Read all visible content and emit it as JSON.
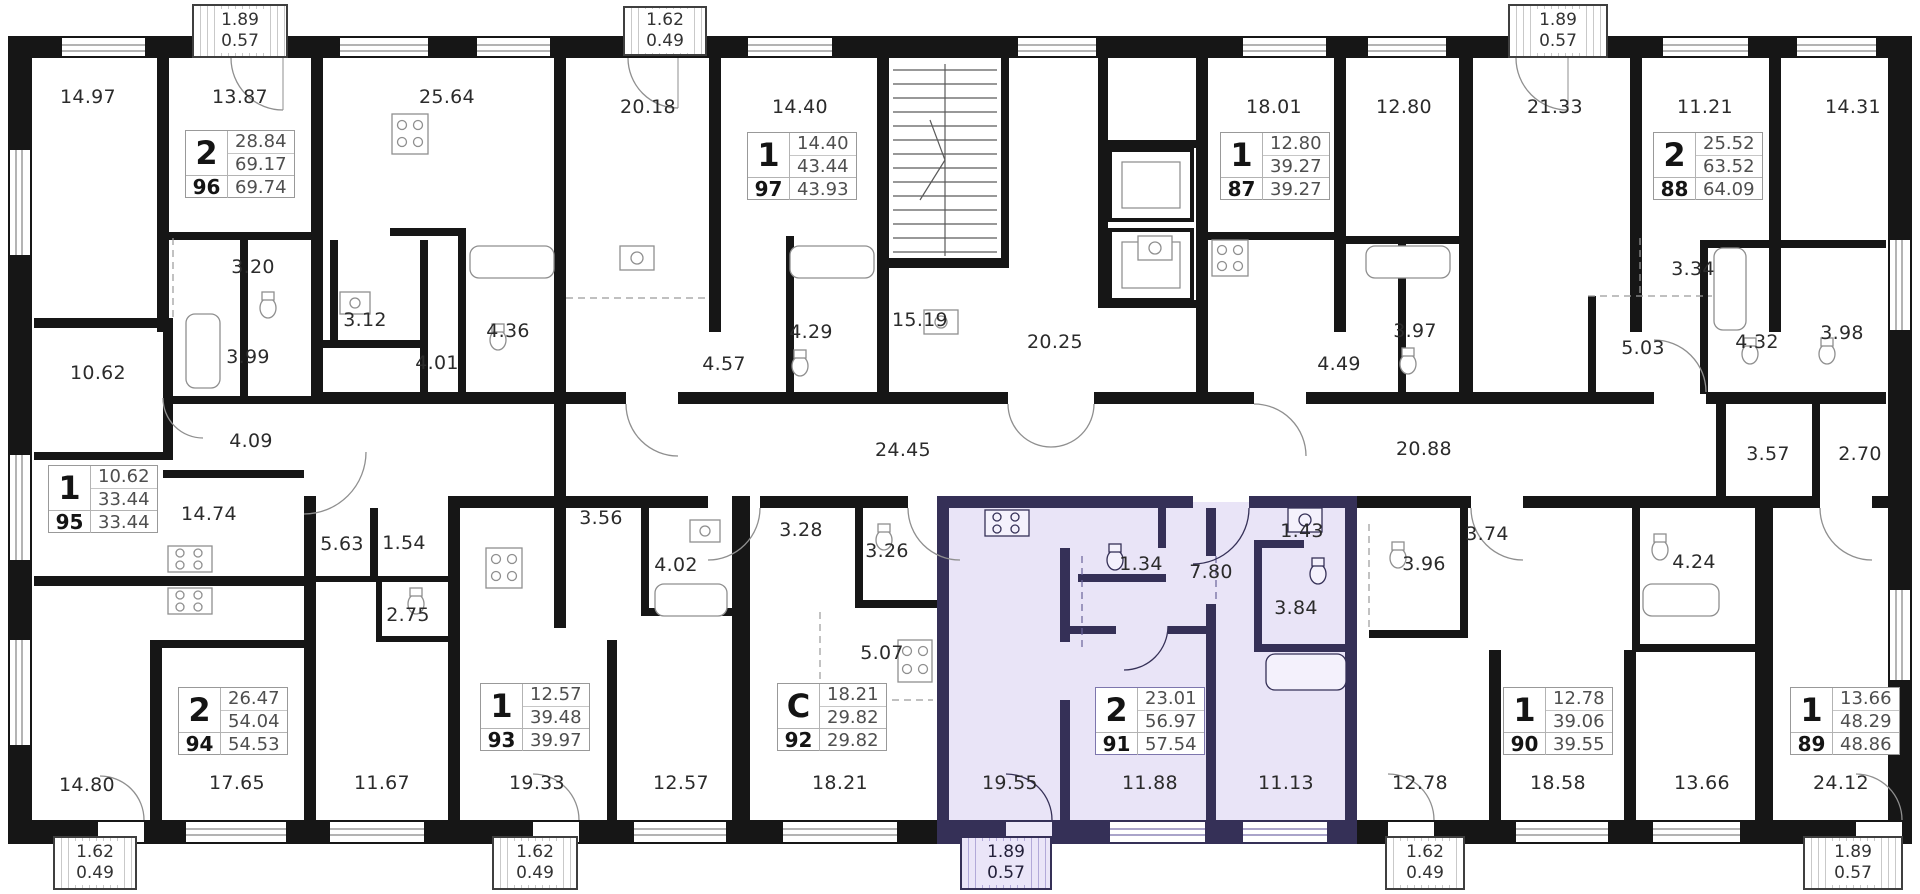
{
  "plan": {
    "colors": {
      "wall": "#161616",
      "highlight_fill": "#e9e4f7",
      "highlight_wall": "#353057",
      "label_text": "#2b2b2b",
      "value_text": "#4f4f4f"
    },
    "room_labels": [
      {
        "t": "14.97",
        "x": 88,
        "y": 97
      },
      {
        "t": "13.87",
        "x": 240,
        "y": 97
      },
      {
        "t": "25.64",
        "x": 447,
        "y": 97
      },
      {
        "t": "20.18",
        "x": 648,
        "y": 107
      },
      {
        "t": "14.40",
        "x": 800,
        "y": 107
      },
      {
        "t": "18.01",
        "x": 1274,
        "y": 107
      },
      {
        "t": "12.80",
        "x": 1404,
        "y": 107
      },
      {
        "t": "21.33",
        "x": 1555,
        "y": 107
      },
      {
        "t": "11.21",
        "x": 1705,
        "y": 107
      },
      {
        "t": "14.31",
        "x": 1853,
        "y": 107
      },
      {
        "t": "3.20",
        "x": 253,
        "y": 267
      },
      {
        "t": "3.12",
        "x": 365,
        "y": 320
      },
      {
        "t": "3.99",
        "x": 248,
        "y": 357
      },
      {
        "t": "10.62",
        "x": 98,
        "y": 373
      },
      {
        "t": "4.01",
        "x": 437,
        "y": 363
      },
      {
        "t": "4.36",
        "x": 508,
        "y": 331
      },
      {
        "t": "4.57",
        "x": 724,
        "y": 364
      },
      {
        "t": "4.29",
        "x": 811,
        "y": 332
      },
      {
        "t": "15.19",
        "x": 920,
        "y": 320
      },
      {
        "t": "20.25",
        "x": 1055,
        "y": 342
      },
      {
        "t": "4.49",
        "x": 1339,
        "y": 364
      },
      {
        "t": "3.97",
        "x": 1415,
        "y": 331
      },
      {
        "t": "3.34",
        "x": 1693,
        "y": 269
      },
      {
        "t": "5.03",
        "x": 1643,
        "y": 348
      },
      {
        "t": "4.32",
        "x": 1757,
        "y": 342
      },
      {
        "t": "3.98",
        "x": 1842,
        "y": 333
      },
      {
        "t": "4.09",
        "x": 251,
        "y": 441
      },
      {
        "t": "24.45",
        "x": 903,
        "y": 450
      },
      {
        "t": "20.88",
        "x": 1424,
        "y": 449
      },
      {
        "t": "3.57",
        "x": 1768,
        "y": 454
      },
      {
        "t": "2.70",
        "x": 1860,
        "y": 454
      },
      {
        "t": "14.74",
        "x": 209,
        "y": 514
      },
      {
        "t": "5.63",
        "x": 342,
        "y": 544
      },
      {
        "t": "1.54",
        "x": 404,
        "y": 543
      },
      {
        "t": "2.75",
        "x": 408,
        "y": 615
      },
      {
        "t": "3.56",
        "x": 601,
        "y": 518
      },
      {
        "t": "4.02",
        "x": 676,
        "y": 565
      },
      {
        "t": "3.28",
        "x": 801,
        "y": 530
      },
      {
        "t": "3.26",
        "x": 887,
        "y": 551
      },
      {
        "t": "5.07",
        "x": 882,
        "y": 653
      },
      {
        "t": "1.34",
        "x": 1141,
        "y": 564
      },
      {
        "t": "7.80",
        "x": 1211,
        "y": 572
      },
      {
        "t": "1.43",
        "x": 1302,
        "y": 531
      },
      {
        "t": "3.84",
        "x": 1296,
        "y": 608
      },
      {
        "t": "3.96",
        "x": 1424,
        "y": 564
      },
      {
        "t": "3.74",
        "x": 1487,
        "y": 534
      },
      {
        "t": "4.24",
        "x": 1694,
        "y": 562
      },
      {
        "t": "14.80",
        "x": 87,
        "y": 785
      },
      {
        "t": "17.65",
        "x": 237,
        "y": 783
      },
      {
        "t": "11.67",
        "x": 382,
        "y": 783
      },
      {
        "t": "19.33",
        "x": 537,
        "y": 783
      },
      {
        "t": "12.57",
        "x": 681,
        "y": 783
      },
      {
        "t": "18.21",
        "x": 840,
        "y": 783
      },
      {
        "t": "19.55",
        "x": 1010,
        "y": 783
      },
      {
        "t": "11.88",
        "x": 1150,
        "y": 783
      },
      {
        "t": "11.13",
        "x": 1286,
        "y": 783
      },
      {
        "t": "12.78",
        "x": 1420,
        "y": 783
      },
      {
        "t": "18.58",
        "x": 1558,
        "y": 783
      },
      {
        "t": "13.66",
        "x": 1702,
        "y": 783
      },
      {
        "t": "24.12",
        "x": 1841,
        "y": 783
      }
    ],
    "apartments": [
      {
        "number": "96",
        "rooms": "2",
        "area_top": "28.84",
        "area_mid": "69.17",
        "area_total": "69.74",
        "x": 185,
        "y": 130,
        "highlighted": false
      },
      {
        "number": "97",
        "rooms": "1",
        "area_top": "14.40",
        "area_mid": "43.44",
        "area_total": "43.93",
        "x": 747,
        "y": 132,
        "highlighted": false
      },
      {
        "number": "87",
        "rooms": "1",
        "area_top": "12.80",
        "area_mid": "39.27",
        "area_total": "39.27",
        "x": 1220,
        "y": 132,
        "highlighted": false
      },
      {
        "number": "88",
        "rooms": "2",
        "area_top": "25.52",
        "area_mid": "63.52",
        "area_total": "64.09",
        "x": 1653,
        "y": 132,
        "highlighted": false
      },
      {
        "number": "95",
        "rooms": "1",
        "area_top": "10.62",
        "area_mid": "33.44",
        "area_total": "33.44",
        "x": 48,
        "y": 465,
        "highlighted": false
      },
      {
        "number": "94",
        "rooms": "2",
        "area_top": "26.47",
        "area_mid": "54.04",
        "area_total": "54.53",
        "x": 178,
        "y": 687,
        "highlighted": false
      },
      {
        "number": "93",
        "rooms": "1",
        "area_top": "12.57",
        "area_mid": "39.48",
        "area_total": "39.97",
        "x": 480,
        "y": 683,
        "highlighted": false
      },
      {
        "number": "92",
        "rooms": "C",
        "area_top": "18.21",
        "area_mid": "29.82",
        "area_total": "29.82",
        "x": 777,
        "y": 683,
        "highlighted": false
      },
      {
        "number": "91",
        "rooms": "2",
        "area_top": "23.01",
        "area_mid": "56.97",
        "area_total": "57.54",
        "x": 1095,
        "y": 687,
        "highlighted": true
      },
      {
        "number": "90",
        "rooms": "1",
        "area_top": "12.78",
        "area_mid": "39.06",
        "area_total": "39.55",
        "x": 1503,
        "y": 687,
        "highlighted": false
      },
      {
        "number": "89",
        "rooms": "1",
        "area_top": "13.66",
        "area_mid": "48.29",
        "area_total": "48.86",
        "x": 1790,
        "y": 687,
        "highlighted": false
      }
    ],
    "balconies": [
      {
        "width_m": "1.89",
        "depth_m": "0.57",
        "x": 192,
        "y": 4,
        "w": 96,
        "h": 54,
        "highlighted": false
      },
      {
        "width_m": "1.62",
        "depth_m": "0.49",
        "x": 623,
        "y": 6,
        "w": 84,
        "h": 50,
        "highlighted": false
      },
      {
        "width_m": "1.89",
        "depth_m": "0.57",
        "x": 1508,
        "y": 4,
        "w": 100,
        "h": 54,
        "highlighted": false
      },
      {
        "width_m": "1.62",
        "depth_m": "0.49",
        "x": 53,
        "y": 836,
        "w": 84,
        "h": 54,
        "highlighted": false
      },
      {
        "width_m": "1.62",
        "depth_m": "0.49",
        "x": 492,
        "y": 836,
        "w": 86,
        "h": 54,
        "highlighted": false
      },
      {
        "width_m": "1.89",
        "depth_m": "0.57",
        "x": 960,
        "y": 836,
        "w": 92,
        "h": 54,
        "highlighted": true
      },
      {
        "width_m": "1.62",
        "depth_m": "0.49",
        "x": 1385,
        "y": 836,
        "w": 80,
        "h": 54,
        "highlighted": false
      },
      {
        "width_m": "1.89",
        "depth_m": "0.57",
        "x": 1803,
        "y": 836,
        "w": 100,
        "h": 54,
        "highlighted": false
      }
    ]
  }
}
